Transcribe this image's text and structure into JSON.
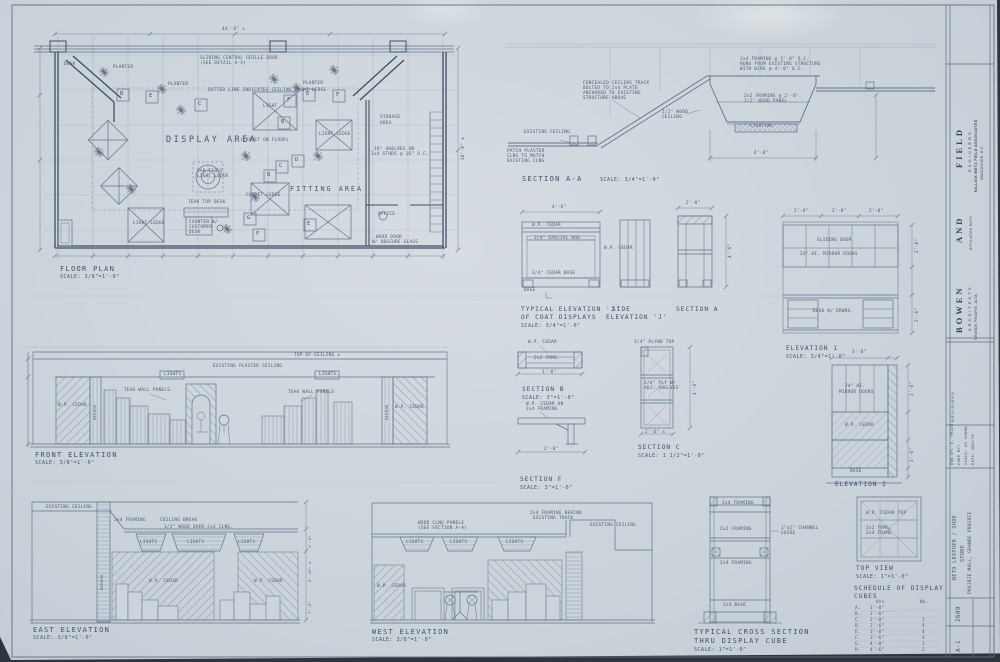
{
  "colors": {
    "paper": "#cdd5dc",
    "pencil": "#4a5b6f",
    "line": "#62748a",
    "dark": "#3e4f63"
  },
  "floor_plan": {
    "title": "FLOOR PLAN",
    "scale": "SCALE: 3/8\"=1'-0\"",
    "display_area": "DISPLAY AREA",
    "display_area_note": "(CARPET ON FLOOR)",
    "fitting_area": "FITTING AREA",
    "storage_1": "STORAGE",
    "storage_2": "AREA",
    "sliding_1": "SLIDING CENTRAL GRILLE DOOR",
    "sliding_2": "(SEE DETAIL A-A)",
    "dotted_note": "DOTTED LINE INDICATES CEILING LIGHT LEDGE",
    "planter": "PLANTER",
    "light": "LIGHT",
    "light_ledge": "LIGHT LEDGE",
    "carpet_ledge": "CARPET LEDGE",
    "oak_1": "OAK TABLE",
    "oak_2": "LIGHT LEDGE",
    "teak_desk": "TEAK TOP DESK",
    "counter_1": "COUNTER W/",
    "counter_2": "CUSTOMER",
    "counter_3": "DESK",
    "office": "OFFICE",
    "wood_door_1": "WOOD DOOR",
    "wood_door_2": "W/ OBSCURE GLASS",
    "shelf_1": "18\" SHELVES ON",
    "shelf_2": "2x4 STUDS @ 16\" O.C.",
    "desk": "DESK",
    "dim_overall": "44'-6\" ±",
    "dim_right": "28'-0\" ±",
    "cube_letters": [
      "B",
      "E",
      "C",
      "F",
      "B",
      "E",
      "F",
      "C",
      "D",
      "B",
      "G",
      "F",
      "E"
    ]
  },
  "section_aa": {
    "title": "SECTION A-A",
    "scale": "SCALE: 3/4\"=1'-0\"",
    "existing_ceiling": "EXISTING CEILING",
    "patch_1": "PATCH PLASTER",
    "patch_2": "CLNG TO MATCH",
    "patch_3": "EXISTING CLNG",
    "track_1": "CONCEALED CEILING TRACK",
    "track_2": "BOLTED TO 2x4 PLATE",
    "track_3": "ANCHORED TO EXISTING",
    "track_4": "STRUCTURE ABOVE",
    "framing_1": "2x4 FRAMING @ 2'-0\" O.C.",
    "framing_2": "HUNG FROM EXISTING STRUCTURE",
    "framing_3": "WITH WIRE @ 4'-0\" O.C.",
    "wood_1": "1/2\" WOOD",
    "wood_2": "CEILING",
    "panel_1": "2x2 FRAMING @ 2'-0\"",
    "panel_2": "1/2\" WOOD PANEL",
    "lighting": "LIGHTING",
    "dim": "4'-0\""
  },
  "elev_j": {
    "title_1": "TYPICAL ELEVATION 'J'",
    "title_2": "OF COAT DISPLAYS",
    "scale": "SCALE: 3/4\"=1'-0\"",
    "side_1": "SIDE",
    "side_2": "ELEVATION 'J'",
    "section_a": "SECTION A",
    "wp_cedar": "W.P. CEDAR",
    "rod": "3/4\" SPECIAL ROD",
    "cedar_base": "3/4\" CEDAR BASE",
    "base": "BASE",
    "dim_w": "4'-6\"",
    "dim_side": "2'-0\""
  },
  "elev_1": {
    "title": "ELEVATION 1",
    "scale": "SCALE: 3/4\"=1'-0\"",
    "sliding": "SLIDING DOOR",
    "mirror_doors": "24\" HI. MIRROR DOORS",
    "desk": "DESK W/ DRWRS.",
    "dims": [
      "2'-8\"",
      "2'-8\"",
      "2'-8\"",
      "2'-0\"",
      "2'-6\""
    ]
  },
  "elev_2": {
    "title": "ELEVATION 2",
    "mirror_1": "24\" HI.",
    "mirror_2": "MIRROR DOORS",
    "wp_cedar": "W.P. CEDAR",
    "base": "BASE",
    "dim_top": "3'-0\"",
    "dim_1": "2'-0\"",
    "dim_2": "2'-6\""
  },
  "section_b": {
    "title": "SECTION B",
    "scale": "SCALE: 3\"=1'-0\"",
    "wp_cedar": "W.P. CEDAR",
    "frmg": "2x2 FRMG.",
    "dim": "1'-6\""
  },
  "section_f": {
    "title": "SECTION F",
    "scale": "SCALE: 3\"=1'-0\"",
    "note_1": "W.P. CEDAR ON",
    "note_2": "2x4 FRAMING",
    "dim": "2'-0\""
  },
  "section_c": {
    "title": "SECTION C",
    "scale": "SCALE: 1 1/2\"=1'-0\"",
    "top": "3/4\" PLYWD TOP",
    "shelves_1": "3/4\" PLY W/",
    "shelves_2": "ADJ. SHELVES",
    "dim_h": "4'-6\"",
    "dim_w": "2'-6\" ±"
  },
  "front_elev": {
    "title": "FRONT ELEVATION",
    "scale": "SCALE: 3/8\"=1'-0\"",
    "top_of_ceiling": "TOP OF CEILING ±",
    "existing": "EXISTING PLASTER CEILING",
    "lights": "LIGHTS",
    "teak": "TEAK WALL PANELS",
    "wp_cedar": "W.P. CEDAR",
    "mirror": "MIRROR"
  },
  "east_elev": {
    "title": "EAST ELEVATION",
    "scale": "SCALE: 3/8\"=1'-0\"",
    "existing": "EXISTING CEILING",
    "framing": "2x4 FRAMING",
    "break": "CEILING BREAK",
    "wood": "1/2\" WOOD OVER 2x4 CLNG.",
    "lights": "LIGHTS",
    "wp_cedar": "W.P. CEDAR",
    "mirror": "MIRROR",
    "dims": [
      "1'-6\"",
      "3'-10\" ±",
      "7'-6\""
    ]
  },
  "west_elev": {
    "title": "WEST ELEVATION",
    "scale": "SCALE: 3/8\"=1'-0\"",
    "framing_1": "2x4 FRAMING BEHIND",
    "framing_2": "EXISTING TRACK",
    "existing": "EXISTING CEILING",
    "panels_1": "WOOD CLNG PANELS",
    "panels_2": "(SEE SECTION A-A)",
    "lights": "LIGHTS",
    "wp_cedar": "W.P. CEDAR"
  },
  "cross_section": {
    "title_1": "TYPICAL CROSS SECTION",
    "title_2": "THRU DISPLAY CUBE",
    "scale": "SCALE: 1\"=1'-0\"",
    "framing_top": "2x4 FRAMING",
    "framing_mid": "2x2 FRAMING",
    "framing_low": "2x4 FRAMING",
    "base": "2x4 BASE",
    "channel_1": "1\"x1\" CHANNEL",
    "channel_2": "GUIDE"
  },
  "top_view": {
    "title": "TOP VIEW",
    "scale": "SCALE: 1\"=1'-0\"",
    "cedar_top": "W.P. CEDAR TOP",
    "frmg_1": "2x2 FRMG.",
    "frmg_2": "2x4 FRAME"
  },
  "schedule": {
    "title_1": "SCHEDULE OF DISPLAY",
    "title_2": "CUBES",
    "col_ht": "Hts",
    "col_no": "No.",
    "rows": [
      {
        "letter": "A.",
        "ht": "1'-0\"",
        "no": ""
      },
      {
        "letter": "B.",
        "ht": "1'-6\"",
        "no": ""
      },
      {
        "letter": "C.",
        "ht": "2'-0\"",
        "no": "2"
      },
      {
        "letter": "D.",
        "ht": "2'-6\"",
        "no": "4"
      },
      {
        "letter": "E.",
        "ht": "3'-0\"",
        "no": "4"
      },
      {
        "letter": "F.",
        "ht": "3'-6\"",
        "no": "4"
      },
      {
        "letter": "G.",
        "ht": "4'-0\"",
        "no": "1"
      },
      {
        "letter": "H.",
        "ht": "4'-6\"",
        "no": "2"
      }
    ]
  },
  "title_block": {
    "firm_1": "BOWEN",
    "firm_2": "AND",
    "firm_3": "FIELD",
    "architects": "ARCHITECTS",
    "engineers": "ENGINEERS",
    "affiliated": "AFFILIATED WITH",
    "associates": "KILLICK METZ FIELD ASSOCIATES",
    "assoc_city": "VANCOUVER, B.C.",
    "firm_city": "GRANDE PRAIRIE, ALTA.",
    "revisions": "REVISIONS",
    "dwn_by": "DWN BY: E. FRAZO",
    "chkd_by": "CHKD BY:",
    "scale": "SCALE: AS SHOWN",
    "date": "DATE: NOV/76",
    "project_1": "NETO LEATHER / SHOE",
    "project_2": "STORE",
    "project_3": "PRAIRIE MALL, GRANDE PRAIRIE",
    "job_no": "2609",
    "sheet_no": "A-1"
  }
}
